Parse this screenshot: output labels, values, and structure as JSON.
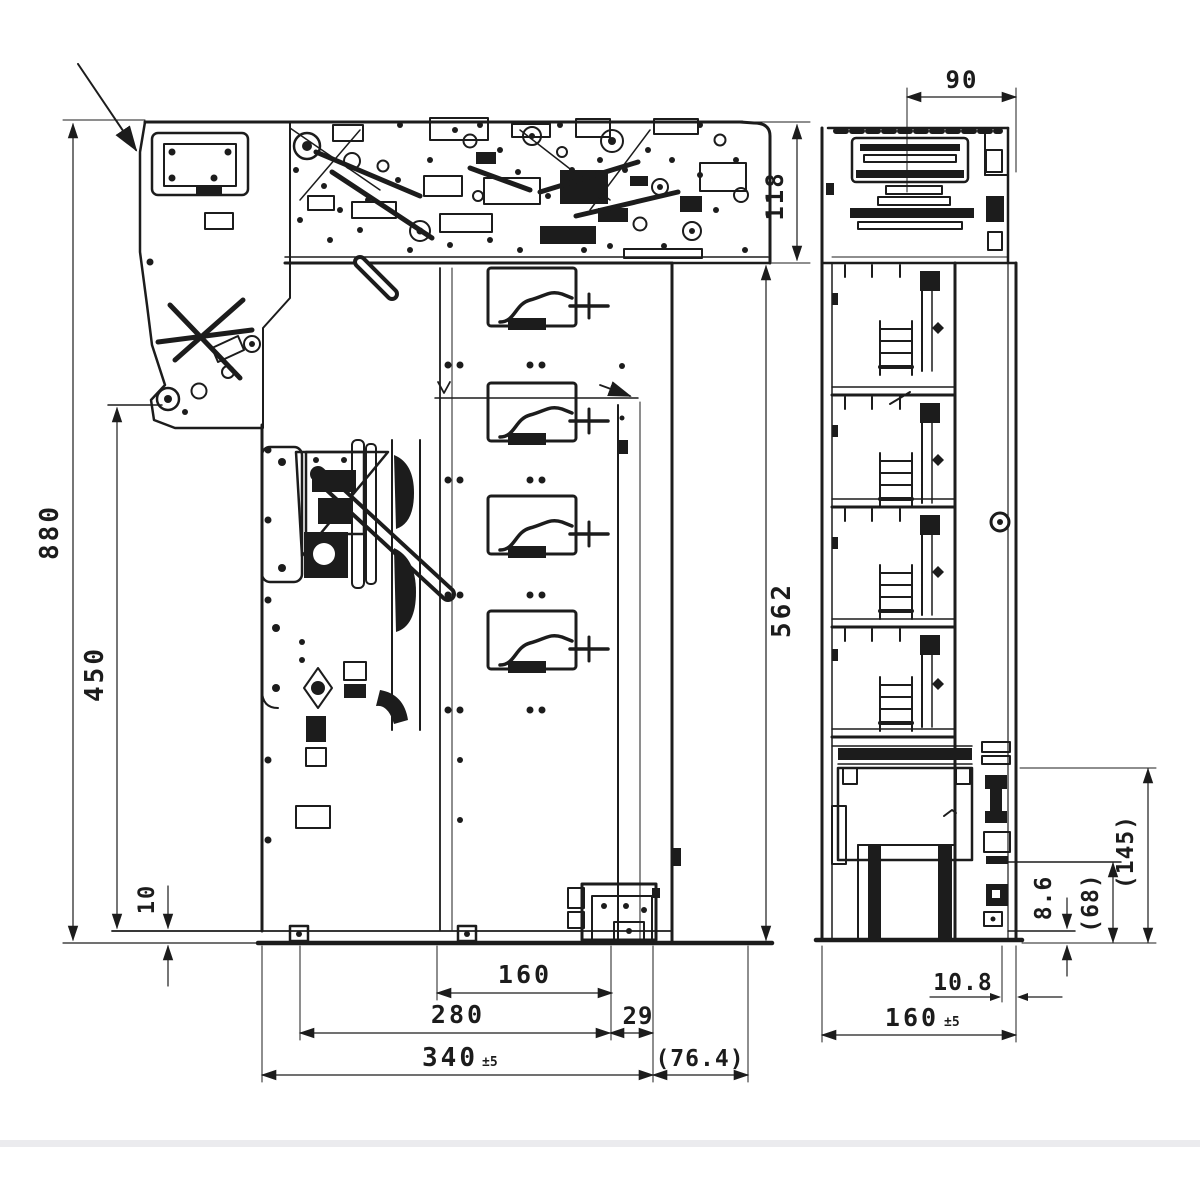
{
  "page": {
    "background": "#ffffff",
    "ink": "#1c1c1c",
    "divider_color": "#ebebee"
  },
  "dimensions": {
    "front": {
      "overall_height": "880",
      "inner_height": "450",
      "base_lip": "10",
      "head_height": "118",
      "body_height": "562",
      "chute_width": "160",
      "mounting_width": "280",
      "offset": "29",
      "overall_width": "340",
      "overall_width_tol": "±5",
      "protrusion": "(76.4)"
    },
    "side": {
      "top_width": "90",
      "depth": "160",
      "depth_tol": "±5",
      "foot_offset": "10.8",
      "step_height": "8.6",
      "ref_height_68": "(68)",
      "ref_height_145": "(145)"
    }
  }
}
